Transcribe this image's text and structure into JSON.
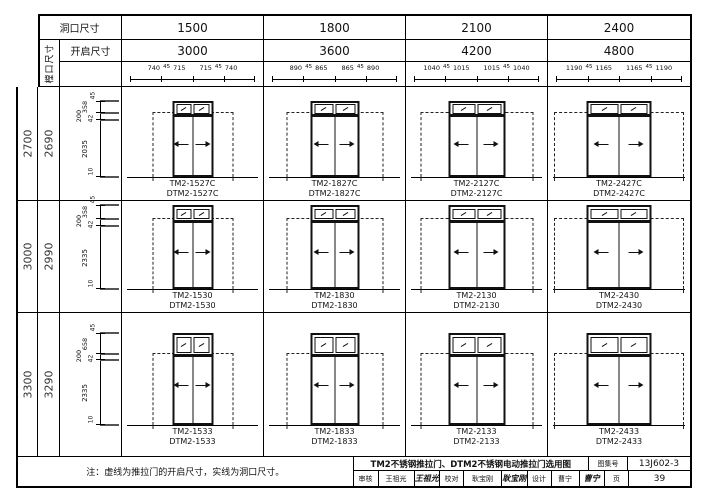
{
  "header": {
    "corner_label": "洞口尺寸",
    "frame_label": "樘口尺寸",
    "opening_label": "开启尺寸",
    "hole_widths": [
      "1500",
      "1800",
      "2100",
      "2400"
    ],
    "opening_widths": [
      "3000",
      "3600",
      "4200",
      "4800"
    ],
    "width_dims": [
      [
        "740",
        "45",
        "715",
        "715",
        "45",
        "740"
      ],
      [
        "890",
        "45",
        "865",
        "865",
        "45",
        "890"
      ],
      [
        "1040",
        "45",
        "1015",
        "1015",
        "45",
        "1040"
      ],
      [
        "1190",
        "45",
        "1165",
        "1165",
        "45",
        "1190"
      ]
    ]
  },
  "rows": [
    {
      "hole_height": "2700",
      "frame_height": "2690",
      "vdims": [
        "45",
        "358",
        "200",
        "42",
        "2035",
        "10"
      ],
      "cells": [
        {
          "tm": "TM2-1527C",
          "dtm": "DTM2-1527C"
        },
        {
          "tm": "TM2-1827C",
          "dtm": "DTM2-1827C"
        },
        {
          "tm": "TM2-2127C",
          "dtm": "DTM2-2127C"
        },
        {
          "tm": "TM2-2427C",
          "dtm": "DTM2-2427C"
        }
      ]
    },
    {
      "hole_height": "3000",
      "frame_height": "2990",
      "vdims": [
        "45",
        "358",
        "200",
        "42",
        "2335",
        "10"
      ],
      "cells": [
        {
          "tm": "TM2-1530",
          "dtm": "DTM2-1530"
        },
        {
          "tm": "TM2-1830",
          "dtm": "DTM2-1830"
        },
        {
          "tm": "TM2-2130",
          "dtm": "DTM2-2130"
        },
        {
          "tm": "TM2-2430",
          "dtm": "DTM2-2430"
        }
      ]
    },
    {
      "hole_height": "3300",
      "frame_height": "3290",
      "vdims": [
        "45",
        "658",
        "200",
        "42",
        "2335",
        "10"
      ],
      "cells": [
        {
          "tm": "TM2-1533",
          "dtm": "DTM2-1533"
        },
        {
          "tm": "TM2-1833",
          "dtm": "DTM2-1833"
        },
        {
          "tm": "TM2-2133",
          "dtm": "DTM2-2133"
        },
        {
          "tm": "TM2-2433",
          "dtm": "DTM2-2433"
        }
      ]
    }
  ],
  "note": "注：虚线为推拉门的开启尺寸，实线为洞口尺寸。",
  "titleblock": {
    "title": "TM2不锈钢推拉门、DTM2不锈钢电动推拉门选用图",
    "atlas_label": "图集号",
    "atlas_no": "13J602-3",
    "review_label": "审核",
    "review_name": "王祖光",
    "review_sig": "王祖光",
    "check_label": "校对",
    "check_name": "耿宝刚",
    "check_sig": "耿宝刚",
    "design_label": "设计",
    "design_name": "曹宁",
    "design_sig": "曹宁",
    "page_label": "页",
    "page_no": "39"
  }
}
